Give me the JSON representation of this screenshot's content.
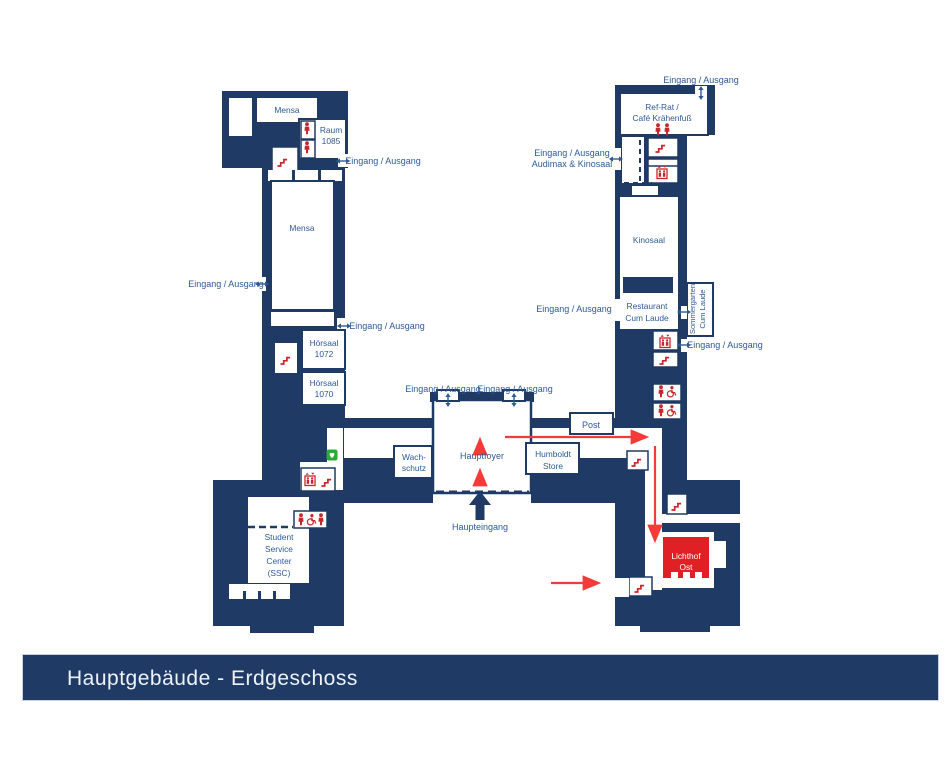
{
  "title": {
    "text": "Hauptgebäude - Erdgeschoss"
  },
  "colors": {
    "building_navy": "#1f3a64",
    "label_blue": "#2d5a96",
    "icon_red": "#c9252c",
    "route_red": "#f43b3a",
    "lichthof_red": "#e02025",
    "aed_green": "#2ea836",
    "titlebar_text": "#eef2f7"
  },
  "rooms": {
    "mensa_top": "Mensa",
    "raum_1085": [
      "Raum",
      "1085"
    ],
    "mensa_main": "Mensa",
    "hoersaal_1072": [
      "Hörsaal",
      "1072"
    ],
    "hoersaal_1070": [
      "Hörsaal",
      "1070"
    ],
    "ssc": [
      "Student",
      "Service",
      "Center",
      "(SSC)"
    ],
    "wachschutz": [
      "Wach-",
      "schutz"
    ],
    "hauptfoyer": "Hauptfoyer",
    "humboldt_store": [
      "Humboldt",
      "Store"
    ],
    "post": "Post",
    "ref_rat": [
      "Ref-Rat /",
      "Café Krähenfuß"
    ],
    "kinosaal": "Kinosaal",
    "restaurant": [
      "Restaurant",
      "Cum Laude"
    ],
    "sommergarten": [
      "Sommergarten",
      "Cum Laude"
    ],
    "lichthof_ost": [
      "Lichthof",
      "Ost"
    ]
  },
  "labels": {
    "eingang_ausgang": "Eingang / Ausgang",
    "audimax_line2": "Audimax & Kinosaal",
    "haupteingang": "Haupteingang"
  },
  "icons": {
    "stairs": "red stair steps",
    "elevator": "red elevator box with two persons",
    "person": "red person (WC)",
    "wheelchair": "red accessible WC",
    "aed": "green defibrillator",
    "entrance_double_arrow": "navy two-headed arrow",
    "main_entrance_arrow": "navy solid up arrow",
    "route_arrow": "red path arrow"
  }
}
